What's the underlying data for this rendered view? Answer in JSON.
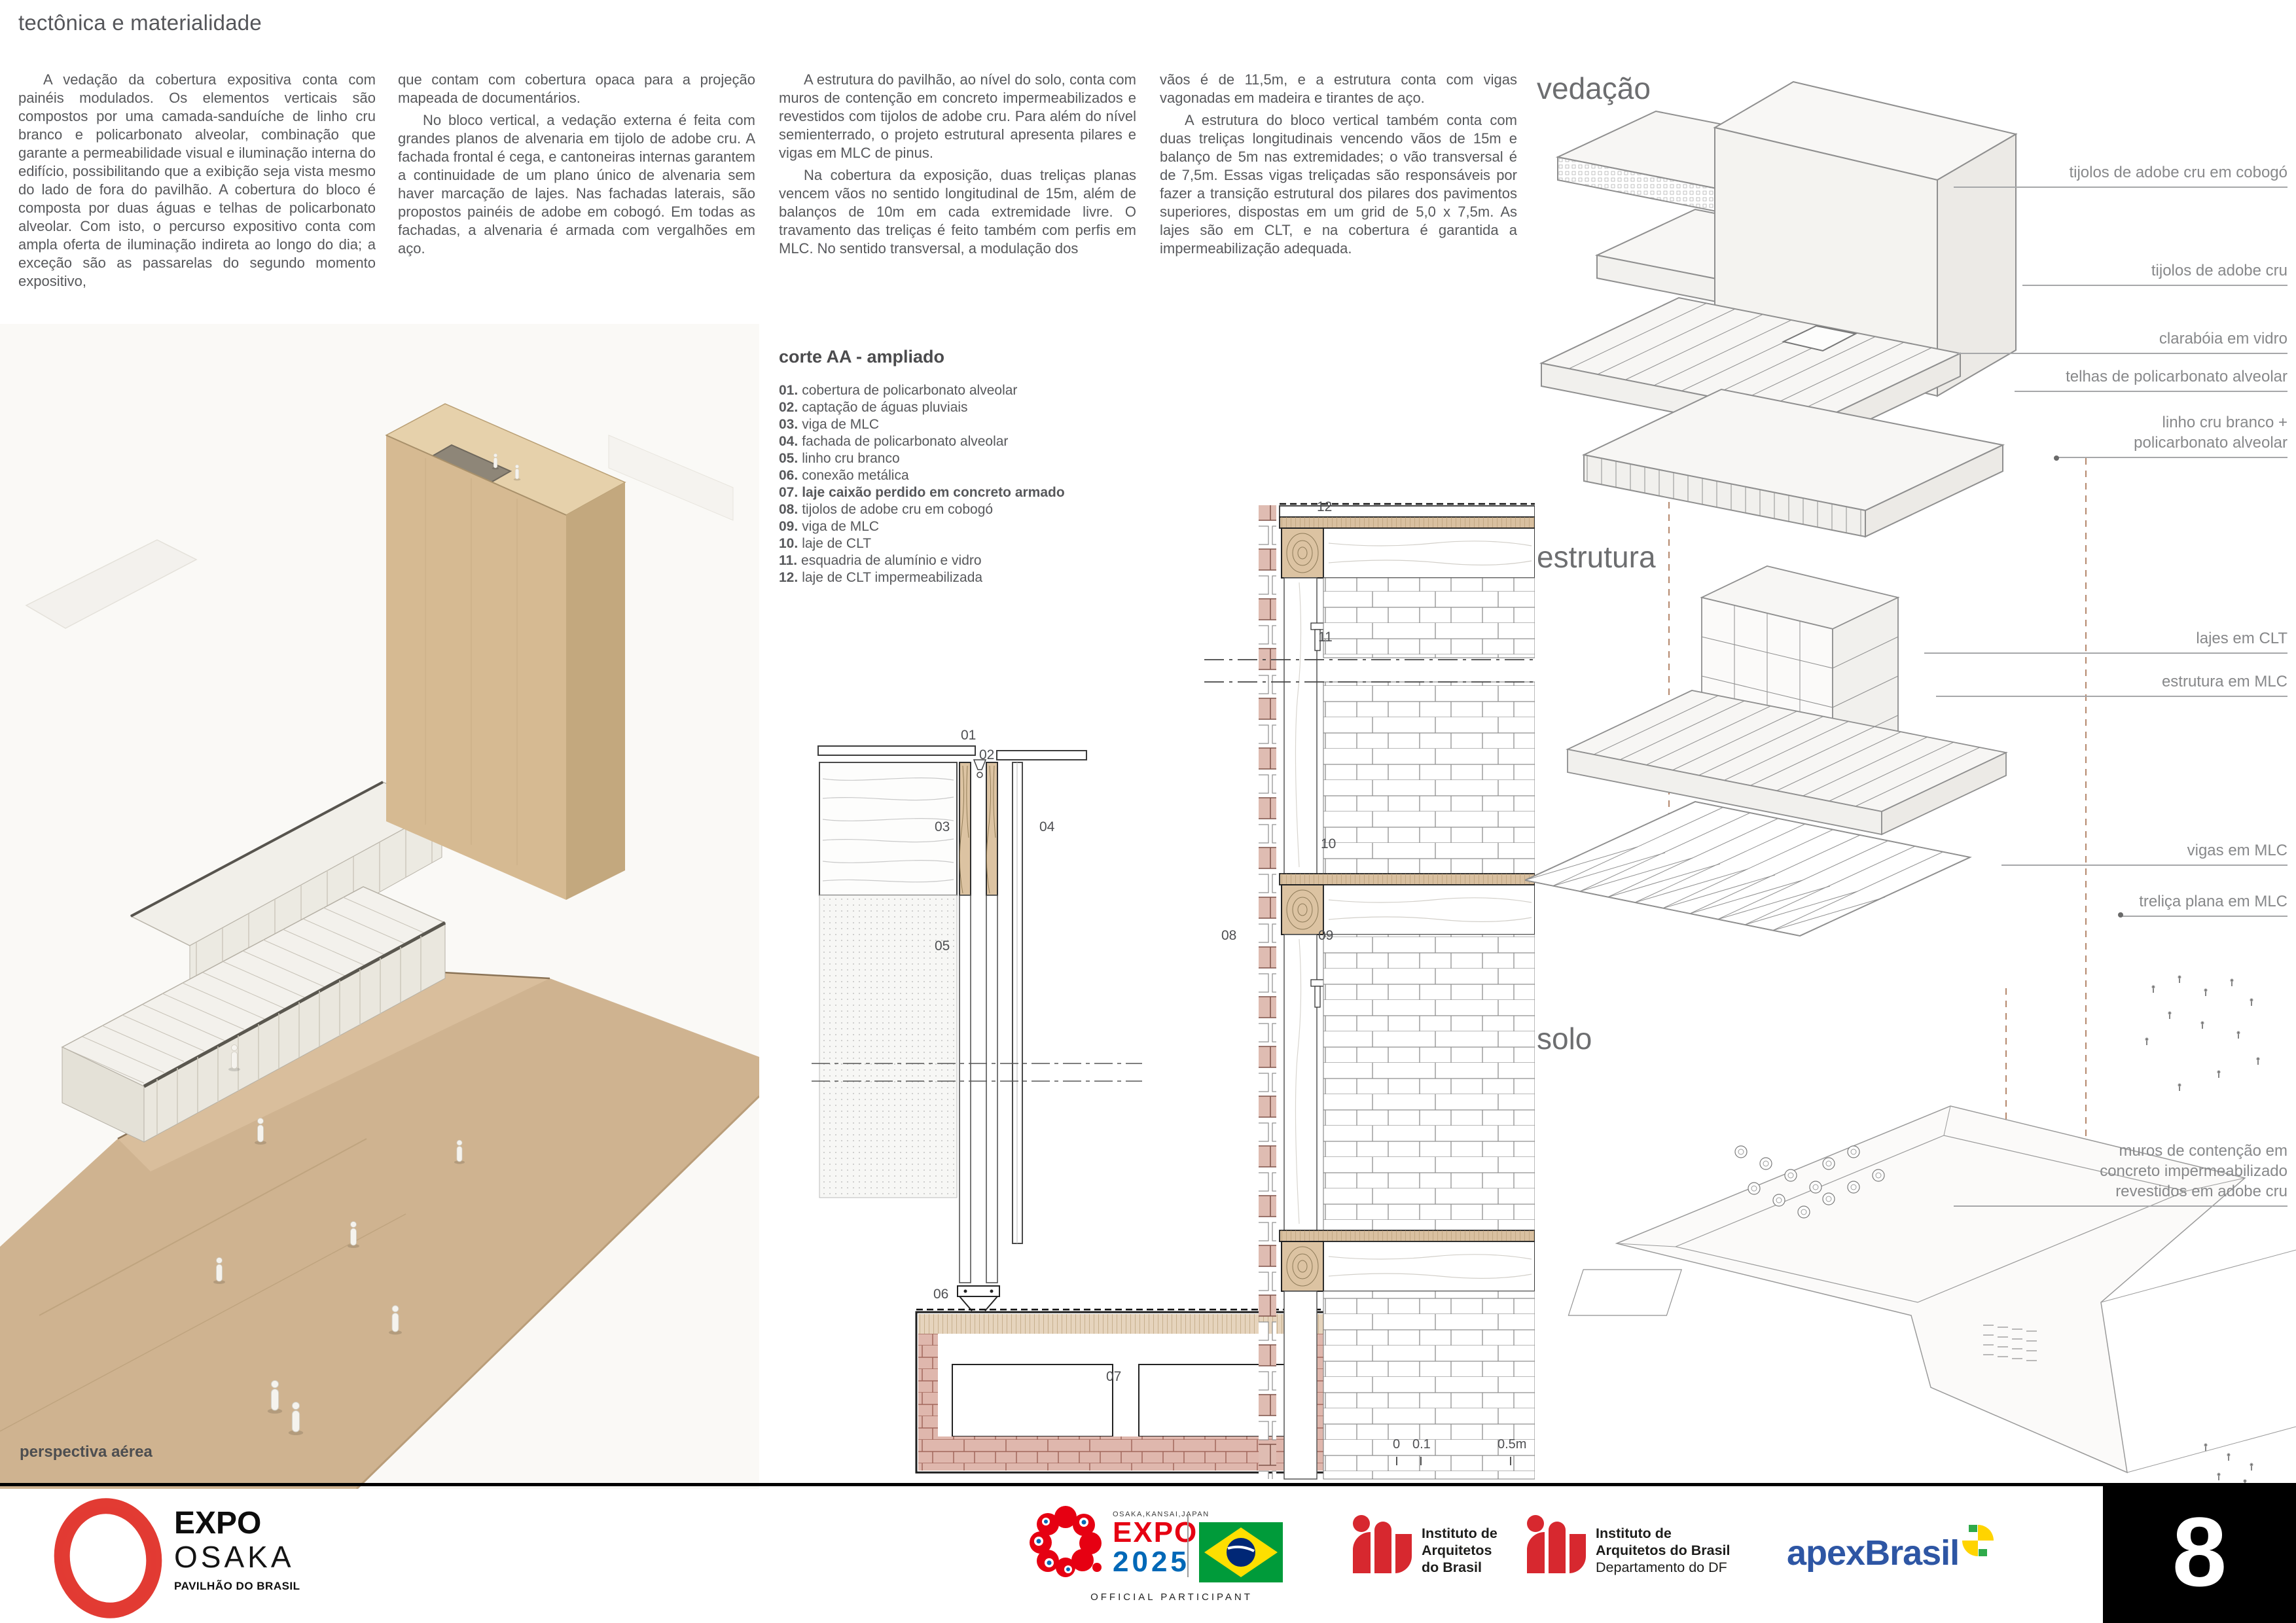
{
  "page": {
    "title": "tectônica e materialidade",
    "perspective_caption": "perspectiva aérea"
  },
  "columns": [
    {
      "paragraphs": [
        "A vedação da cobertura expositiva conta com painéis modulados. Os elementos verticais são compostos por uma camada-sanduíche de linho cru branco e policarbonato alveolar, combinação que garante a permeabilidade visual e iluminação interna do edifício, possibilitando que a exibição seja vista mesmo do lado de fora do pavilhão. A cobertura do bloco é composta por duas águas e telhas de policarbonato alveolar. Com isto, o percurso expositivo conta com ampla oferta de iluminação indireta ao longo do dia; a exceção são as passarelas do segundo momento expositivo,"
      ]
    },
    {
      "paragraphs": [
        "que contam com cobertura opaca para a projeção mapeada de documentários.",
        "No bloco vertical, a vedação externa é feita com grandes planos de alvenaria em tijolo de adobe cru. A fachada frontal é cega, e cantoneiras internas garantem a continuidade de um plano único de alvenaria sem haver marcação de lajes. Nas fachadas laterais, são propostos painéis de adobe em cobogó. Em todas as fachadas, a alvenaria é armada com vergalhões em aço."
      ]
    },
    {
      "paragraphs": [
        "A estrutura do pavilhão, ao nível do solo, conta com muros de contenção em concreto impermeabilizados e revestidos com tijolos de adobe cru. Para além do nível semienterrado, o projeto estrutural apresenta pilares e vigas em MLC de pinus.",
        "Na cobertura da exposição, duas treliças planas vencem vãos no sentido longitudinal de 15m, além de balanços de 10m em cada extremidade livre. O travamento das treliças é feito também com perfis em MLC. No sentido transversal, a modulação dos"
      ]
    },
    {
      "paragraphs": [
        "vãos é de 11,5m, e a estrutura conta com vigas vagonadas em madeira e tirantes de aço.",
        "A estrutura do bloco vertical também conta com duas treliças longitudinais vencendo vãos de 15m e balanço de 5m nas extremidades; o vão transversal é de 7,5m. Essas vigas treliçadas são responsáveis por fazer a transição estrutural dos pilares dos pavimentos superiores, dispostas em um grid de 5,0 x 7,5m. As lajes são em CLT, e na cobertura é garantida a impermeabilização adequada."
      ]
    }
  ],
  "corte": {
    "title": "corte AA - ampliado",
    "legend": [
      {
        "n": "01.",
        "t": "cobertura de policarbonato alveolar"
      },
      {
        "n": "02.",
        "t": "captação de águas pluviais"
      },
      {
        "n": "03.",
        "t": "viga de MLC"
      },
      {
        "n": "04.",
        "t": "fachada de policarbonato alveolar"
      },
      {
        "n": "05.",
        "t": "linho cru branco"
      },
      {
        "n": "06.",
        "t": "conexão metálica"
      },
      {
        "n": "07.",
        "t": "laje caixão perdido em concreto armado"
      },
      {
        "n": "08.",
        "t": "tijolos de adobe cru em cobogó"
      },
      {
        "n": "09.",
        "t": "viga de MLC"
      },
      {
        "n": "10.",
        "t": "laje de CLT"
      },
      {
        "n": "11.",
        "t": "esquadria de alumínio e vidro"
      },
      {
        "n": "12.",
        "t": "laje de CLT impermeabilizada"
      }
    ],
    "markers": [
      "01",
      "02",
      "03",
      "04",
      "05",
      "06",
      "07",
      "08",
      "09",
      "10",
      "11",
      "12"
    ],
    "scale": {
      "zero": "0",
      "one": "0.1",
      "half": "0.5m"
    }
  },
  "axon": {
    "headings": [
      "vedação",
      "estrutura",
      "solo"
    ],
    "labels": [
      {
        "l1": "tijolos de adobe cru em cobogó"
      },
      {
        "l1": "tijolos de adobe cru"
      },
      {
        "l1": "clarabóia em vidro"
      },
      {
        "l1": "telhas de policarbonato alveolar"
      },
      {
        "l1": "linho cru branco +",
        "l2": "policarbonato alveolar"
      },
      {
        "l1": "lajes em CLT"
      },
      {
        "l1": "estrutura em MLC"
      },
      {
        "l1": "vigas em MLC"
      },
      {
        "l1": "treliça plana em MLC"
      },
      {
        "l1": "muros de contenção em",
        "l2": "concreto impermeabilizado",
        "l3": "revestidos em adobe cru"
      }
    ]
  },
  "footer": {
    "expo_osaka": {
      "expo": "EXPO",
      "osaka": "OSAKA",
      "sub": "PAVILHÃO DO BRASIL"
    },
    "expo2025": {
      "top": "OSAKA,KANSAI,JAPAN",
      "expo": "EXPO",
      "year": "2025",
      "participant": "OFFICIAL PARTICIPANT"
    },
    "iab1": {
      "l1": "Instituto de",
      "l2": "Arquitetos",
      "l3": "do Brasil"
    },
    "iab2": {
      "l1": "Instituto de",
      "l2": "Arquitetos do Brasil",
      "l3": "Departamento do DF"
    },
    "apex": {
      "wordmark": "apexBrasil"
    },
    "page_number": "8"
  },
  "colors": {
    "expo_red": "#e60012",
    "expo_blue": "#0068b7",
    "iab_red": "#d7282f",
    "apex_blue": "#2e56a4",
    "flag_green": "#009b3a",
    "flag_yellow": "#fedf00",
    "flag_blue": "#002776",
    "wood": "#d9c0a0",
    "adobe": "#ddb3a9"
  }
}
